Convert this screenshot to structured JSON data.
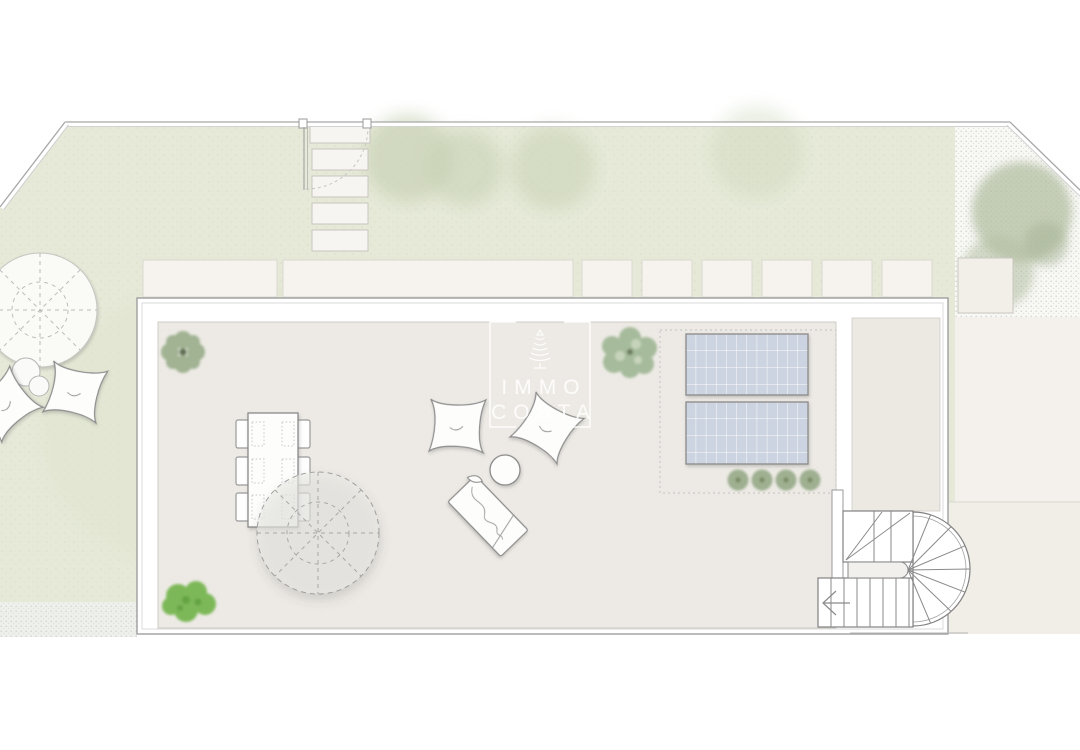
{
  "watermark": {
    "line1": "IMMO",
    "line2": "COSTA",
    "icon": "cypress-tree-icon"
  },
  "palette": {
    "background": "#ffffff",
    "lawn_green": "#e6e9d8",
    "terrace_floor": "#edeae5",
    "right_room_floor": "#ece8e2",
    "paver_light": "#f6f3ee",
    "gravel_light": "#f7f7f4",
    "solar_panel_blue": "#cdd4e1",
    "plant_sage": "#9db08f",
    "bush_bright_green": "#7db858",
    "outline_grey": "#8e8e8e",
    "watermark_white": "rgba(255,255,255,0.85)"
  },
  "plan_inventory": {
    "garden_lawn": 1,
    "boundary_fence_runs": 3,
    "garden_gate": 1,
    "stepping_stones": 5,
    "paver_slabs_row": 8,
    "corner_paver": 1,
    "garden_parasol": 1,
    "garden_bean_bags": 2,
    "garden_side_tables": 2,
    "roof_terrace": 1,
    "dining_table": 1,
    "dining_chairs": 6,
    "table_parasol": 1,
    "terrace_bean_bags": 2,
    "round_side_table": 1,
    "sun_lounger": 1,
    "solar_panels": 2,
    "shrubs_row": 4,
    "terrace_plants": 3,
    "curved_staircase": 1,
    "gravel_area_with_tree": 1,
    "garden_trees": 3
  }
}
